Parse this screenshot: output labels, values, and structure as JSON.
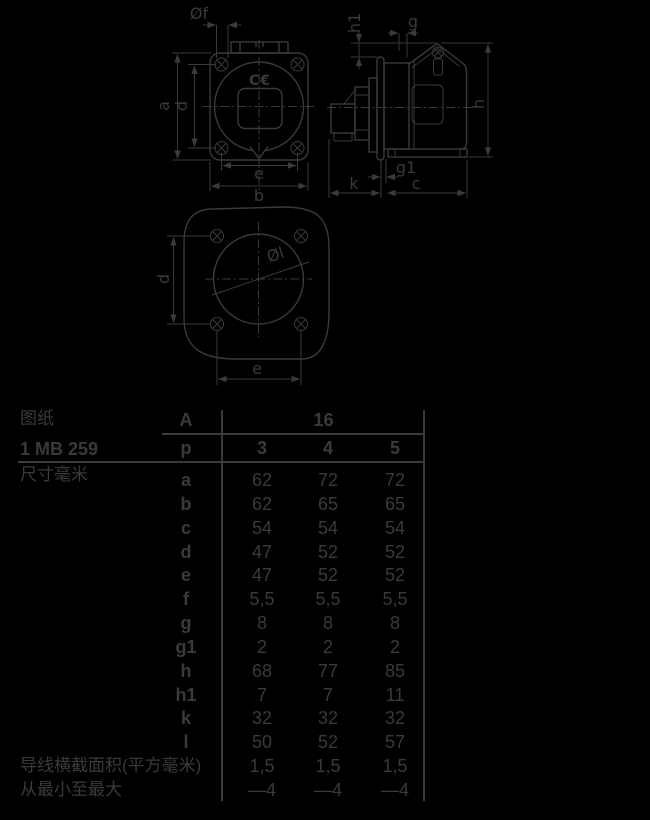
{
  "colors": {
    "background": "#000000",
    "ink": "#3a3a3a"
  },
  "drawing": {
    "front": {
      "hole_dia_label": "Øf",
      "height_label": "a",
      "hole_pitch_v_label": "d",
      "hole_pitch_h_label": "e",
      "width_label": "b",
      "ce_mark": "C€"
    },
    "side": {
      "h1_label": "h1",
      "g_label": "g",
      "h_label": "h",
      "g1_label": "g1",
      "k_label": "k",
      "c_label": "c"
    },
    "rear": {
      "socket_dia_label": "Øl",
      "d_label": "d",
      "e_label": "e"
    }
  },
  "table": {
    "sheet_label": "图纸",
    "sheet_code": "1 MB 259",
    "dims_label": "尺寸毫米",
    "header": {
      "current_col": "A",
      "current_value": "16",
      "poles_col": "p",
      "pole_values": [
        "3",
        "4",
        "5"
      ]
    },
    "rows": [
      {
        "letter": "a",
        "values": [
          "62",
          "72",
          "72"
        ]
      },
      {
        "letter": "b",
        "values": [
          "62",
          "65",
          "65"
        ]
      },
      {
        "letter": "c",
        "values": [
          "54",
          "54",
          "54"
        ]
      },
      {
        "letter": "d",
        "values": [
          "47",
          "52",
          "52"
        ]
      },
      {
        "letter": "e",
        "values": [
          "47",
          "52",
          "52"
        ]
      },
      {
        "letter": "f",
        "values": [
          "5,5",
          "5,5",
          "5,5"
        ]
      },
      {
        "letter": "g",
        "values": [
          "8",
          "8",
          "8"
        ]
      },
      {
        "letter": "g1",
        "values": [
          "2",
          "2",
          "2"
        ]
      },
      {
        "letter": "h",
        "values": [
          "68",
          "77",
          "85"
        ]
      },
      {
        "letter": "h1",
        "values": [
          "7",
          "7",
          "11"
        ]
      },
      {
        "letter": "k",
        "values": [
          "32",
          "32",
          "32"
        ]
      },
      {
        "letter": "l",
        "values": [
          "50",
          "52",
          "57"
        ]
      }
    ],
    "wire_section": {
      "label": "导线横截面积(平方毫米)",
      "values": [
        "1,5",
        "1,5",
        "1,5"
      ]
    },
    "wire_range": {
      "label": "从最小至最大",
      "values": [
        "—4",
        "—4",
        "—4"
      ]
    }
  }
}
